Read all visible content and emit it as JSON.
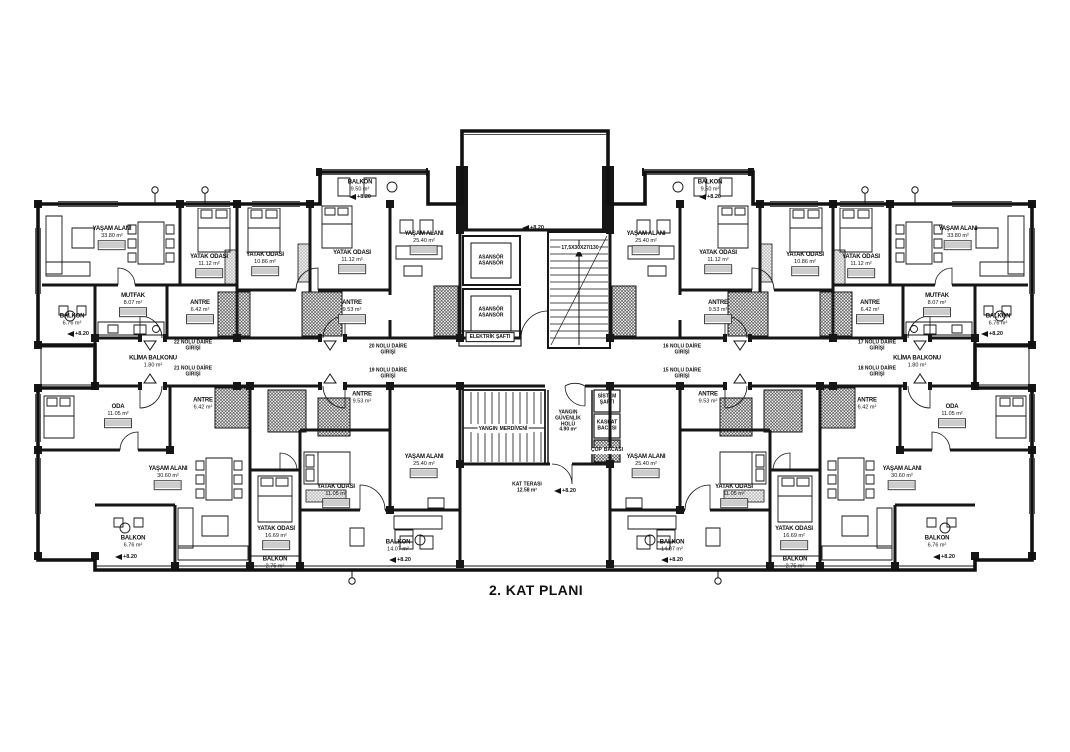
{
  "title": "2. KAT PLANI",
  "elevation": "+8.20",
  "klima": {
    "name": "KLİMA BALKONU",
    "area": "1.80 m²"
  },
  "rooms": [
    {
      "name": "YAŞAM ALANI",
      "area": "33.80 m²"
    },
    {
      "name": "MUTFAK",
      "area": "8.07 m²"
    },
    {
      "name": "BALKON",
      "area": "6.76 m²"
    },
    {
      "name": "ANTRE",
      "area": "6.42 m²"
    },
    {
      "name": "YATAK ODASI",
      "area": "11.12 m²"
    },
    {
      "name": "YATAK ODASI",
      "area": "10.86 m²"
    },
    {
      "name": "YATAK ODASI",
      "area": "11.12 m²"
    },
    {
      "name": "YAŞAM ALANI",
      "area": "25.40 m²"
    },
    {
      "name": "ANTRE",
      "area": "9.53 m²"
    },
    {
      "name": "BALKON",
      "area": "9.50 m²"
    },
    {
      "name": "YAŞAM ALANI",
      "area": "33.80 m²"
    },
    {
      "name": "MUTFAK",
      "area": "8.07 m²"
    },
    {
      "name": "BALKON",
      "area": "6.76 m²"
    },
    {
      "name": "ANTRE",
      "area": "6.42 m²"
    },
    {
      "name": "YATAK ODASI",
      "area": "11.12 m²"
    },
    {
      "name": "YATAK ODASI",
      "area": "10.86 m²"
    },
    {
      "name": "YATAK ODASI",
      "area": "11.12 m²"
    },
    {
      "name": "YAŞAM ALANI",
      "area": "25.40 m²"
    },
    {
      "name": "ANTRE",
      "area": "9.53 m²"
    },
    {
      "name": "BALKON",
      "area": "9.50 m²"
    },
    {
      "name": "ODA",
      "area": "11.05 m²"
    },
    {
      "name": "YAŞAM ALANI",
      "area": "30.60 m²"
    },
    {
      "name": "YATAK ODASI",
      "area": "16.69 m²"
    },
    {
      "name": "BALKON",
      "area": "6.76 m²"
    },
    {
      "name": "BALKON",
      "area": "2.75 m²"
    },
    {
      "name": "ANTRE",
      "area": "6.42 m²"
    },
    {
      "name": "ANTRE",
      "area": "9.53 m²"
    },
    {
      "name": "YATAK ODASI",
      "area": "11.05 m²"
    },
    {
      "name": "BALKON",
      "area": "14.07 m²"
    },
    {
      "name": "YAŞAM ALANI",
      "area": "25.40 m²"
    },
    {
      "name": "ODA",
      "area": "11.05 m²"
    },
    {
      "name": "YAŞAM ALANI",
      "area": "30.60 m²"
    },
    {
      "name": "YATAK ODASI",
      "area": "16.69 m²"
    },
    {
      "name": "BALKON",
      "area": "6.76 m²"
    },
    {
      "name": "BALKON",
      "area": "2.75 m²"
    },
    {
      "name": "ANTRE",
      "area": "6.42 m²"
    },
    {
      "name": "ANTRE",
      "area": "9.53 m²"
    },
    {
      "name": "YATAK ODASI",
      "area": "11.05 m²"
    },
    {
      "name": "BALKON",
      "area": "14.07 m²"
    },
    {
      "name": "YAŞAM ALANI",
      "area": "25.40 m²"
    }
  ],
  "entrances": [
    {
      "line1": "22 NOLU DAİRE",
      "line2": "GİRİŞİ"
    },
    {
      "line1": "21 NOLU DAİRE",
      "line2": "GİRİŞİ"
    },
    {
      "line1": "20 NOLU DAİRE",
      "line2": "GİRİŞİ"
    },
    {
      "line1": "19 NOLU DAİRE",
      "line2": "GİRİŞİ"
    },
    {
      "line1": "16 NOLU DAİRE",
      "line2": "GİRİŞİ"
    },
    {
      "line1": "15 NOLU DAİRE",
      "line2": "GİRİŞİ"
    },
    {
      "line1": "17 NOLU DAİRE",
      "line2": "GİRİŞİ"
    },
    {
      "line1": "18 NOLU DAİRE",
      "line2": "GİRİŞİ"
    }
  ],
  "core": {
    "asansor": "ASANSÖR",
    "elektrik_safti": "ELEKTRİK ŞAFTI",
    "stair_spec": "17,5X30X27/130",
    "yangin_l1": "YANGIN",
    "yangin_l2": "MERDİVENİ",
    "hol_l1": "YANGIN",
    "hol_l2": "GÜVENLİK",
    "hol_l3": "HOLÜ",
    "hol_area": "4.90 m²",
    "sistem_l1": "SİSTEM",
    "sistem_l2": "ŞAFTI",
    "kaskat_l1": "KASKAT",
    "kaskat_l2": "BACASI",
    "cop_l1": "ÇÖP",
    "cop_l2": "BACASI",
    "teras": "KAT TERASI",
    "teras_area": "12.58 m²"
  }
}
